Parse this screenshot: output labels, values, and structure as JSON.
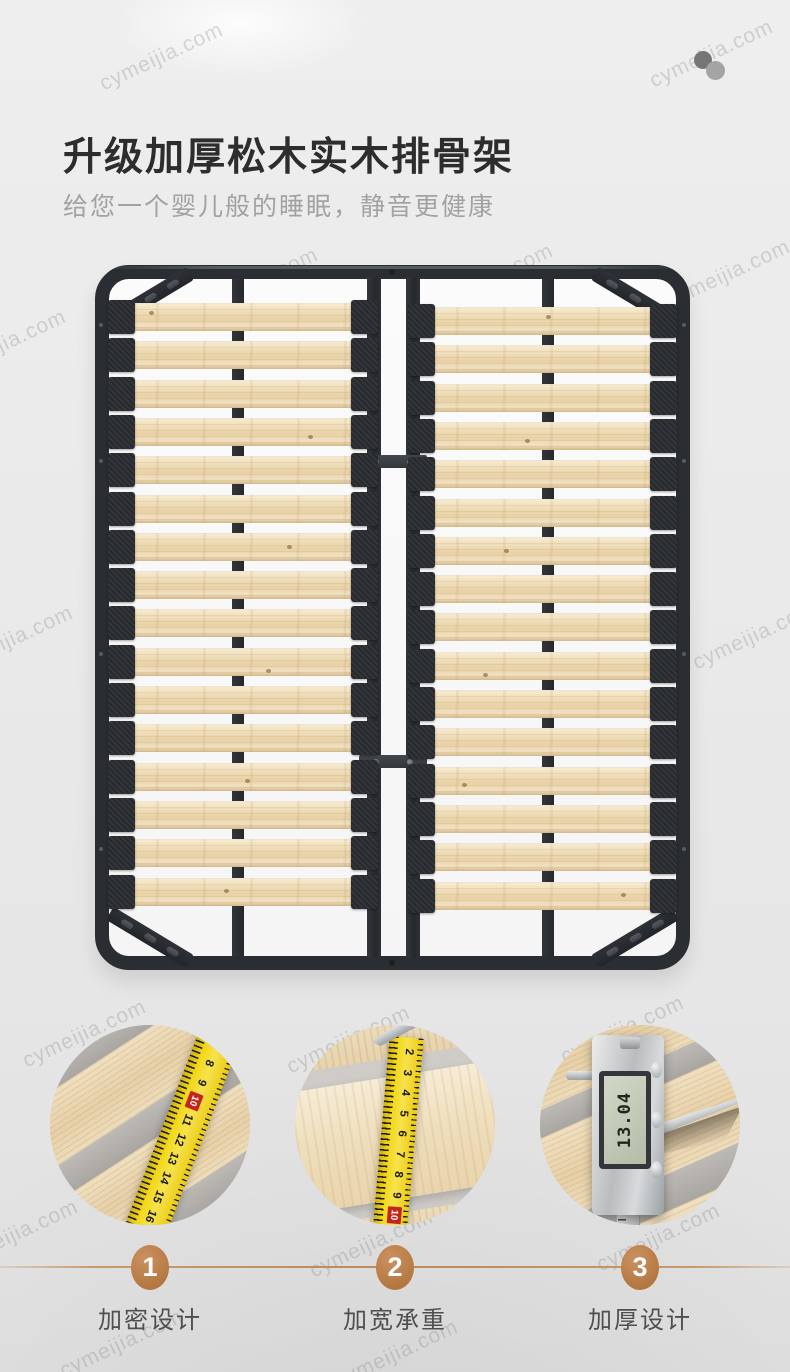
{
  "page": {
    "watermark_text": "cymeijia.com"
  },
  "header": {
    "title": "升级加厚松木实木排骨架",
    "subtitle": "给您一个婴儿般的睡眠，静音更健康"
  },
  "product_photo": {
    "alt": "黑色金属床架配松木排骨条，两半结构",
    "slats_per_half": 16,
    "frame_color": "#2a2d31",
    "slat_color": "#efddb8",
    "cap_color": "#26292d"
  },
  "detail_circles": [
    {
      "id": "slat-spacing",
      "photo": "tape-measure-across-slats",
      "tape_numbers": [
        "6",
        "7",
        "8",
        "9",
        "10",
        "11",
        "12",
        "13",
        "14",
        "15",
        "16",
        "17"
      ]
    },
    {
      "id": "slat-width",
      "photo": "tape-measure-on-slat-width",
      "tape_numbers": [
        "2",
        "3",
        "4",
        "5",
        "6",
        "7",
        "8",
        "9",
        "10",
        "11"
      ]
    },
    {
      "id": "slat-thickness",
      "photo": "digital-caliper-on-slat",
      "caliper_display": "13.04",
      "caliper_buttons": [
        "ZERO",
        "ON/OFF",
        "mm/in"
      ]
    }
  ],
  "features": [
    {
      "number": "1",
      "label": "加密设计"
    },
    {
      "number": "2",
      "label": "加宽承重"
    },
    {
      "number": "3",
      "label": "加厚设计"
    }
  ],
  "colors": {
    "badge": "#bd8251",
    "timeline_line": "#c89a6b",
    "tape_yellow": "#f2d818",
    "tape_marker_red": "#c4251b",
    "title": "#2d2d2d",
    "subtitle": "#a2a2a2"
  }
}
